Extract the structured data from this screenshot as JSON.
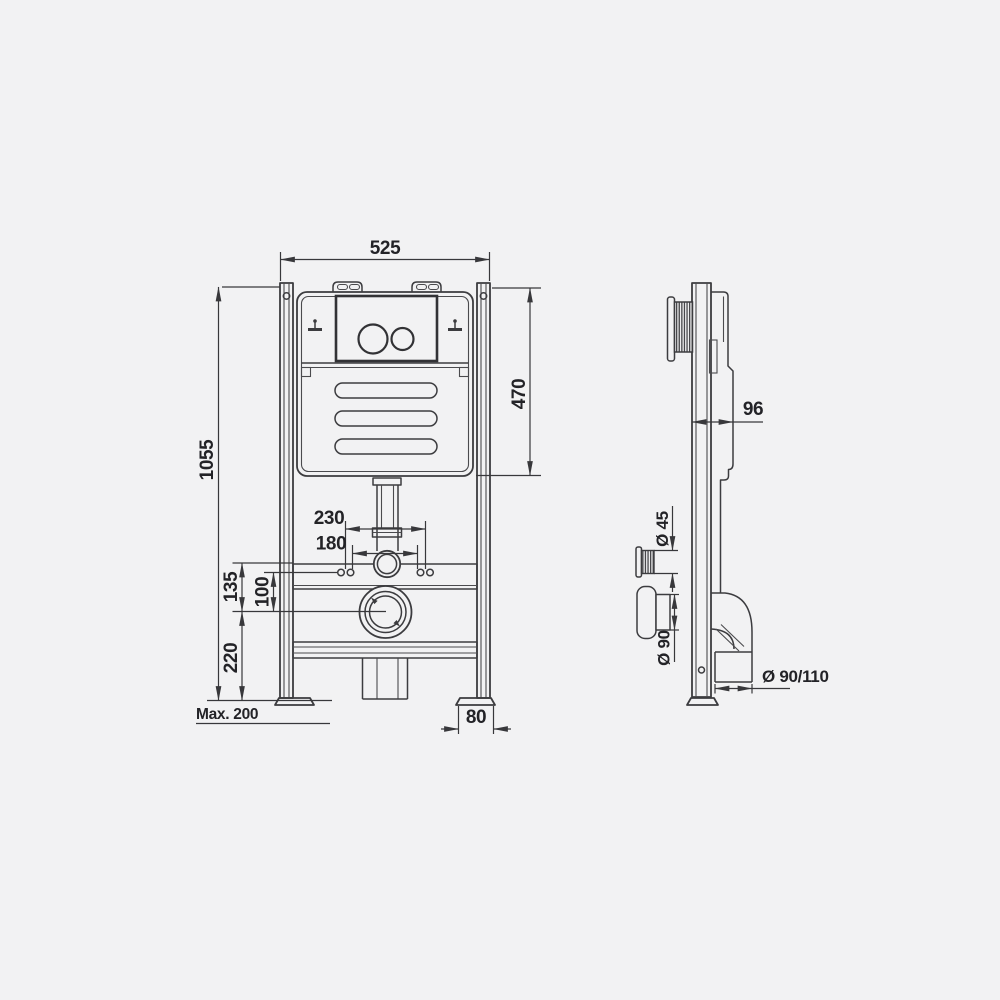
{
  "drawing": {
    "description": "Concealed wall-hung WC cistern frame installation diagram, front view and side view",
    "background_color": "#f2f2f3",
    "line_color": "#3c3c3f",
    "dimensions": {
      "overall_width": "525",
      "overall_height": "1055",
      "tank_zone_height": "470",
      "fixing_spacing_outer": "230",
      "fixing_spacing_inner": "180",
      "connector_to_outlet": "135",
      "fixings_to_outlet": "100",
      "outlet_height": "220",
      "max_leg_adjustment": "Max. 200",
      "foot_width": "80",
      "frame_depth": "96",
      "inlet_diameter": "Ø 45",
      "outlet_diameter": "Ø 90",
      "drain_diameter": "Ø 90/110"
    }
  }
}
